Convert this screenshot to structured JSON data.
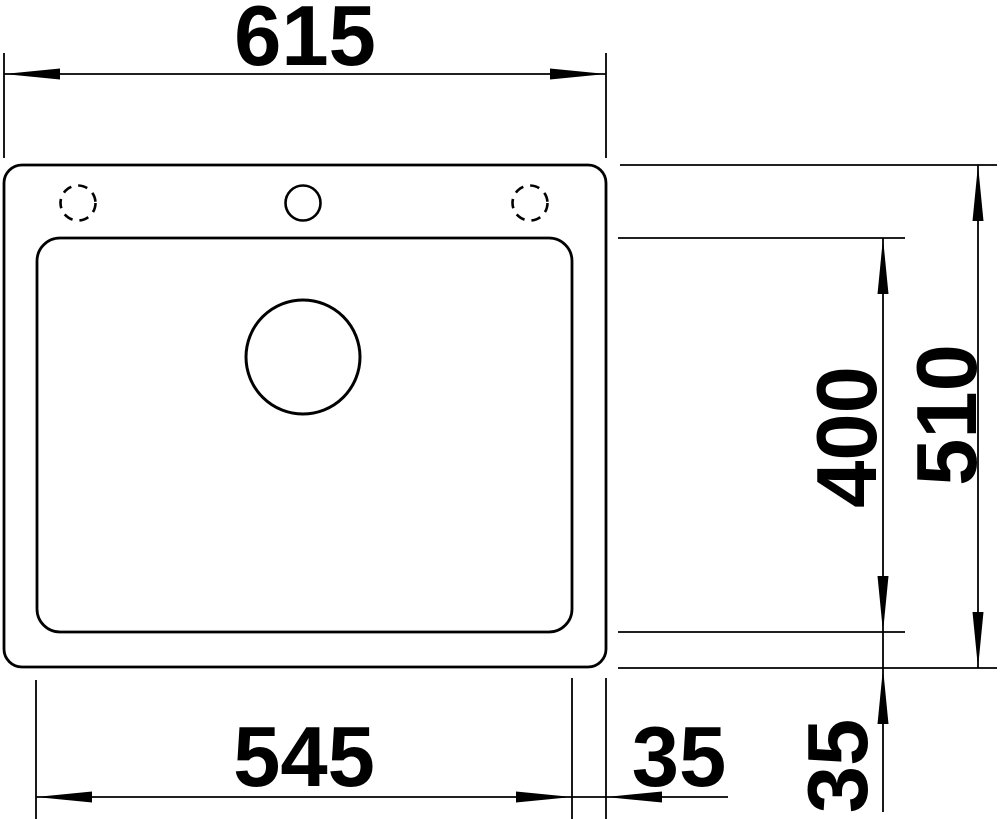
{
  "diagram": {
    "type": "technical-drawing",
    "view": "sink top view with installation dimensions",
    "units_implied": "mm",
    "colors": {
      "line": "#000000",
      "background": "#ffffff"
    },
    "dimensions": {
      "overall_width": "615",
      "bowl_width": "545",
      "right_offset": "35",
      "bowl_depth": "400",
      "overall_depth": "510",
      "bottom_offset": "35"
    }
  }
}
